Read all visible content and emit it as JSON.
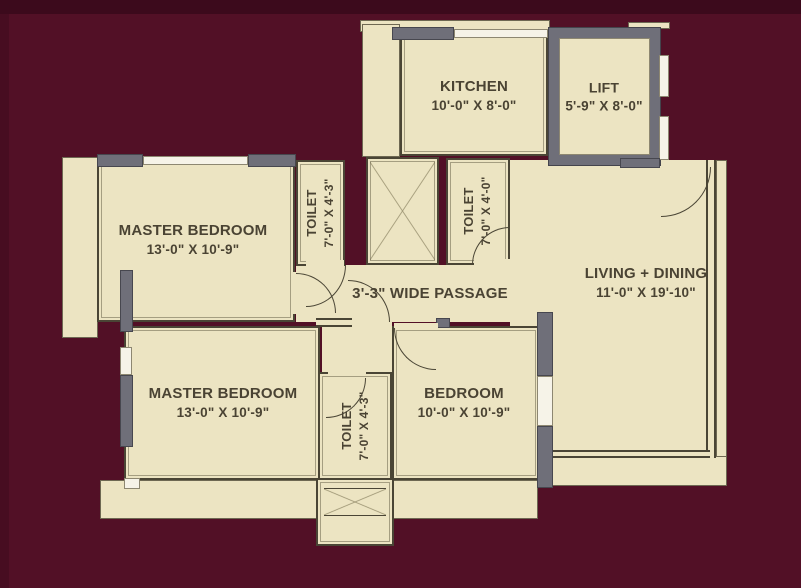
{
  "palette": {
    "background": "#521026",
    "background_top_band": "#3c0a1c",
    "room_fill": "#ece4c2",
    "wall_line": "#4a4535",
    "wall_gray": "#6f6f79",
    "window_fill": "#f6f3e8",
    "label_text": "#4a4333"
  },
  "rooms": {
    "kitchen": {
      "name": "KITCHEN",
      "dims": "10'-0\" X 8'-0\""
    },
    "lift": {
      "name": "LIFT",
      "dims": "5'-9\" X 8'-0\""
    },
    "master_bedroom_1": {
      "name": "MASTER BEDROOM",
      "dims": "13'-0\" X 10'-9\""
    },
    "toilet_1": {
      "name": "TOILET",
      "dims": "7'-0\" X 4'-3\""
    },
    "toilet_2": {
      "name": "TOILET",
      "dims": "7'-0\" X 4'-0\""
    },
    "living_dining": {
      "name": "LIVING + DINING",
      "dims": "11'-0\" X 19'-10\""
    },
    "passage": {
      "label": "3'-3\" WIDE PASSAGE"
    },
    "master_bedroom_2": {
      "name": "MASTER BEDROOM",
      "dims": "13'-0\" X 10'-9\""
    },
    "bedroom": {
      "name": "BEDROOM",
      "dims": "10'-0\" X 10'-9\""
    },
    "toilet_3": {
      "name": "TOILET",
      "dims": "7'-0\" X 4'-3\""
    }
  }
}
